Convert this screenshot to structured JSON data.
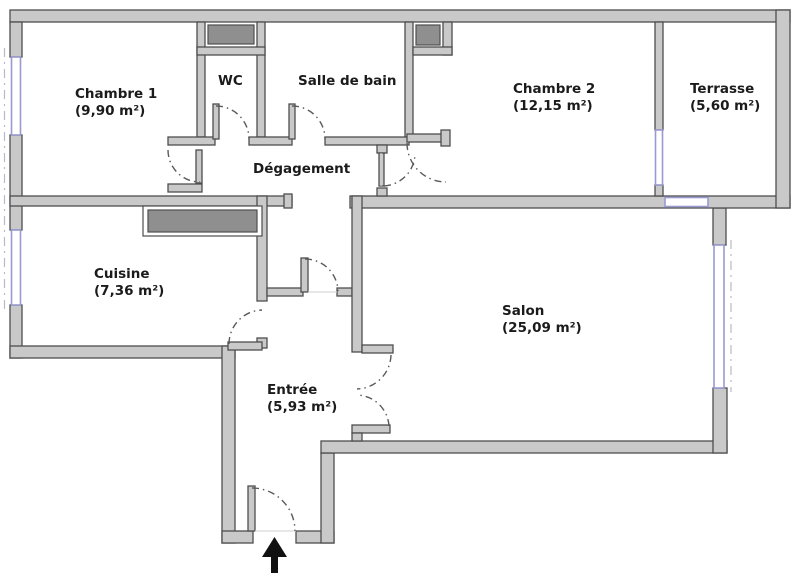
{
  "plan": {
    "type": "apartment-floor-plan",
    "rooms": [
      {
        "id": "chambre1",
        "name": "Chambre 1",
        "area": "(9,90 m²)"
      },
      {
        "id": "wc",
        "name": "WC",
        "area": ""
      },
      {
        "id": "salle-de-bain",
        "name": "Salle de bain",
        "area": ""
      },
      {
        "id": "chambre2",
        "name": "Chambre 2",
        "area": "(12,15 m²)"
      },
      {
        "id": "terrasse",
        "name": "Terrasse",
        "area": "(5,60 m²)"
      },
      {
        "id": "degagement",
        "name": "Dégagement",
        "area": ""
      },
      {
        "id": "cuisine",
        "name": "Cuisine",
        "area": "(7,36 m²)"
      },
      {
        "id": "salon",
        "name": "Salon",
        "area": "(25,09 m²)"
      },
      {
        "id": "entree",
        "name": "Entrée",
        "area": "(5,93 m²)"
      }
    ],
    "entrance_marker": "arrow-up"
  },
  "colors": {
    "wall-fill": "#c9c9c9",
    "wall-stroke": "#4e4e4e",
    "closet-fill": "#8f8f8f",
    "window-stroke": "#9a9ad2",
    "door-arc": "#5a5a5a",
    "label-color": "#1b1b1b",
    "bg": "#ffffff",
    "arrow": "#111111"
  }
}
